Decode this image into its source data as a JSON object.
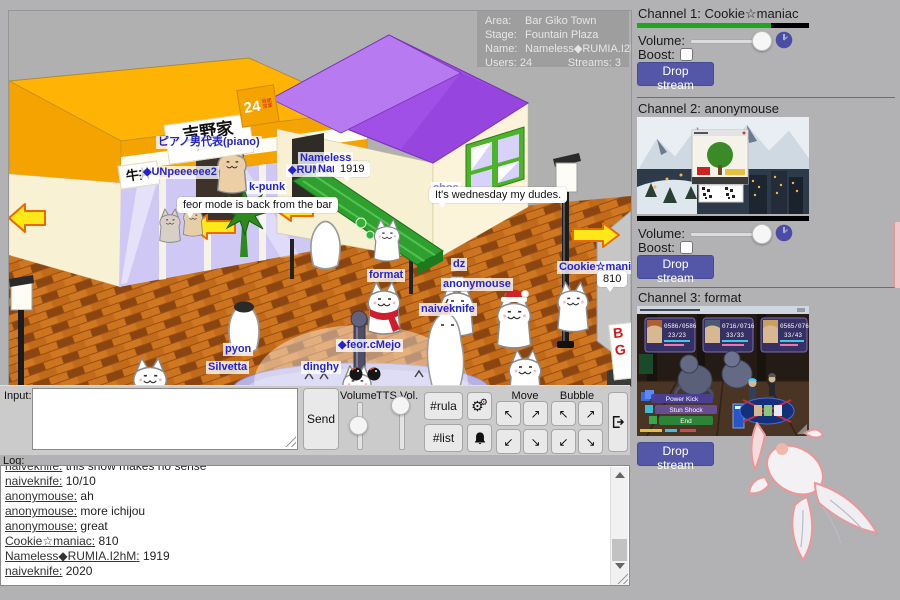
{
  "info": {
    "area_label": "Area:",
    "area": "Bar Giko Town",
    "stage_label": "Stage:",
    "stage": "Fountain Plaza",
    "name_label": "Name:",
    "name": "Nameless◆RUMIA.I2hM",
    "users_label": "Users:",
    "users": "24",
    "streams_label": "Streams:",
    "streams": "3"
  },
  "signs": {
    "gyudon": "牛丼",
    "yoshinoya": "吉野家",
    "yoshinoya_sub": "yoshinoya",
    "hours": "24",
    "hours_sub": "時間営業",
    "bar_b": "B",
    "bar_g": "G"
  },
  "players": {
    "piano": "ピアノ男代表(piano)",
    "unp": "◆UNpeeeeee2",
    "kpunk": "k-punk",
    "nameless_l1": "Nameless",
    "nameless_l2": "◆RUMIA.I2hM",
    "nameless_bg": "Nameless",
    "chos": "chos",
    "format": "format",
    "dz": "dz",
    "anonymouse": "anonymouse",
    "naiveknife": "naiveknife",
    "cookie": "Cookie☆maniac",
    "pyon": "pyon",
    "silvetta": "Silvetta",
    "dinghy": "dinghy",
    "feor": "◆feor.cMejo"
  },
  "bubbles": {
    "b1919": "1919",
    "wednesday": "It's wednesday my dudes.",
    "feor_bar": "feor mode is back from the bar",
    "b810": "810"
  },
  "ctrl": {
    "input_label": "Input:",
    "send": "Send",
    "volume": "Volume",
    "tts": "TTS Vol.",
    "rula": "#rula",
    "list": "#list",
    "move": "Move",
    "bubble": "Bubble"
  },
  "arrows": {
    "nw": "↖",
    "ne": "↗",
    "sw": "↙",
    "se": "↘"
  },
  "icons": {
    "gear": "⚙"
  },
  "log": {
    "label": "Log:",
    "messages": [
      {
        "user": "naiveknife",
        "text": " this show makes no sense"
      },
      {
        "user": "naiveknife",
        "text": " 10/10"
      },
      {
        "user": "anonymouse",
        "text": " ah"
      },
      {
        "user": "anonymouse",
        "text": " more ichijou"
      },
      {
        "user": "anonymouse",
        "text": " great"
      },
      {
        "user": "Cookie☆maniac",
        "text": " 810"
      },
      {
        "user": "Nameless◆RUMIA.I2hM",
        "text": " 1919"
      },
      {
        "user": "naiveknife",
        "text": " 2020"
      }
    ]
  },
  "channels": [
    {
      "title": "Channel 1: Cookie☆maniac",
      "volume_label": "Volume:",
      "boost_label": "Boost:",
      "drop_label": "Drop stream"
    },
    {
      "title": "Channel 2: anonymouse",
      "volume_label": "Volume:",
      "boost_label": "Boost:",
      "drop_label": "Drop stream"
    },
    {
      "title": "Channel 3: format",
      "drop_label": "Drop stream",
      "game_menu": [
        "Power Kick",
        "Stun Shock",
        "End"
      ],
      "hud": [
        {
          "hp": "0586/0586",
          "sp": "23/23"
        },
        {
          "hp": "0716/0716",
          "sp": "33/33"
        },
        {
          "hp": "0565/0763",
          "sp": "33/43"
        }
      ]
    }
  ],
  "colors": {
    "accent": "#5457a8",
    "stream_ok": "#1fa51f",
    "name_blue": "#2424cc",
    "exit_arrow": "#ffe81a"
  }
}
